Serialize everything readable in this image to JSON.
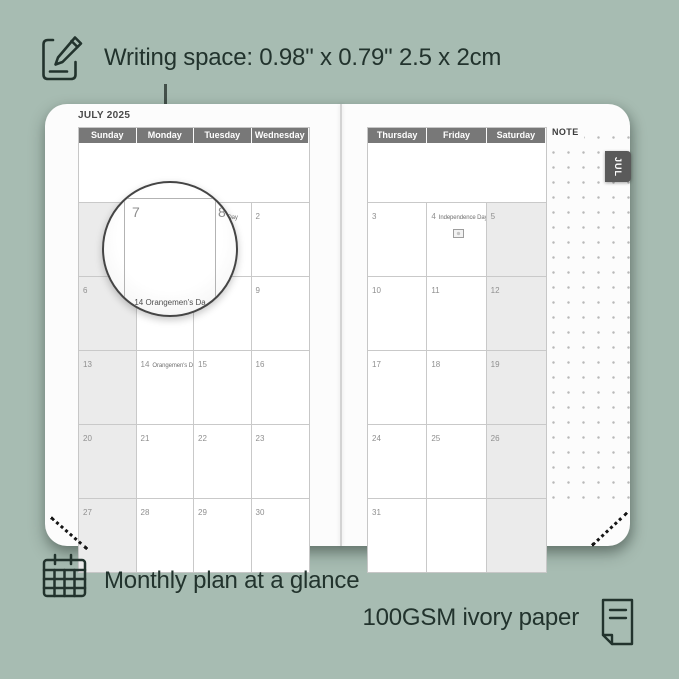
{
  "annotations": {
    "writing_space": "Writing space: 0.98\" x 0.79\" 2.5 x 2cm",
    "monthly_plan": "Monthly plan at a glance",
    "paper": "100GSM ivory paper"
  },
  "planner": {
    "title": "JULY 2025",
    "month_tab": "JUL",
    "note_label": "NOTE",
    "left_page": {
      "day_headers": [
        "Sunday",
        "Monday",
        "Tuesday",
        "Wednesday"
      ],
      "shaded_column": 0,
      "rows": [
        [
          {
            "day": ""
          },
          {
            "day": ""
          },
          {
            "day": "1",
            "event": "Canada Day",
            "flag": "canada-flag-icon",
            "flag_pos": "inline"
          },
          {
            "day": "2"
          }
        ],
        [
          {
            "day": "6"
          },
          {
            "day": "7"
          },
          {
            "day": "8"
          },
          {
            "day": "9"
          }
        ],
        [
          {
            "day": "13"
          },
          {
            "day": "14",
            "event": "Orangemen's Day"
          },
          {
            "day": "15"
          },
          {
            "day": "16"
          }
        ],
        [
          {
            "day": "20"
          },
          {
            "day": "21"
          },
          {
            "day": "22"
          },
          {
            "day": "23"
          }
        ],
        [
          {
            "day": "27"
          },
          {
            "day": "28"
          },
          {
            "day": "29"
          },
          {
            "day": "30"
          }
        ]
      ]
    },
    "right_page": {
      "day_headers": [
        "Thursday",
        "Friday",
        "Saturday"
      ],
      "shaded_column": 2,
      "rows": [
        [
          {
            "day": "3"
          },
          {
            "day": "4",
            "event": "Independence Day",
            "flag": "us-flag-icon",
            "flag_pos": "below"
          },
          {
            "day": "5"
          }
        ],
        [
          {
            "day": "10"
          },
          {
            "day": "11"
          },
          {
            "day": "12"
          }
        ],
        [
          {
            "day": "17"
          },
          {
            "day": "18"
          },
          {
            "day": "19"
          }
        ],
        [
          {
            "day": "24"
          },
          {
            "day": "25"
          },
          {
            "day": "26"
          }
        ],
        [
          {
            "day": "31"
          },
          {
            "day": ""
          },
          {
            "day": ""
          }
        ]
      ]
    },
    "magnifier": {
      "big_day": "7",
      "side_day": "8",
      "bottom_text": "14 Orangemen's Da"
    }
  },
  "colors": {
    "background": "#a7bcb2",
    "ink": "#22332d",
    "header_bg": "#787878",
    "shaded_cell": "#ebebeb",
    "page": "#fcfcfc",
    "tab_bg": "#5a5a5a",
    "grid_line": "#c9c9c9"
  }
}
